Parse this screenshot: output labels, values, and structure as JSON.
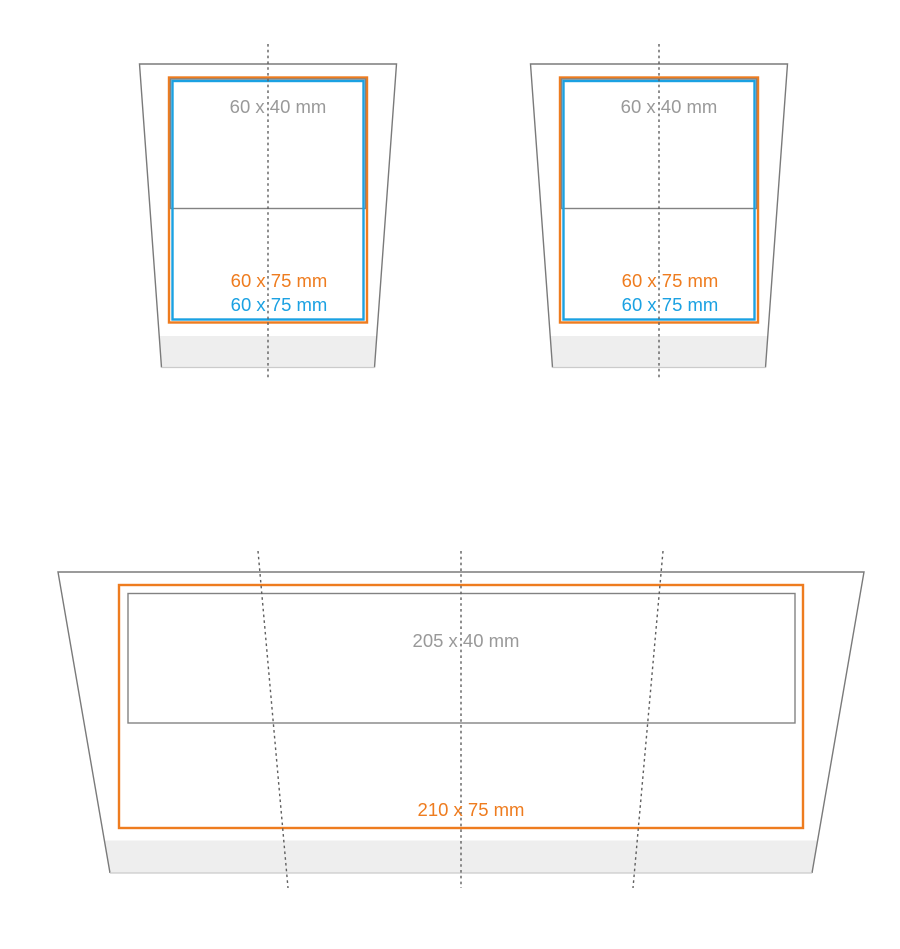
{
  "figures": {
    "cup_left": {
      "print_label": "60 x 40 mm",
      "max_label": "60 x 75 mm",
      "imprint_label": "60 x 75 mm"
    },
    "cup_right": {
      "print_label": "60 x 40 mm",
      "max_label": "60 x 75 mm",
      "imprint_label": "60 x 75 mm"
    },
    "wrap": {
      "print_label": "205 x 40 mm",
      "max_label": "210 x 75 mm"
    }
  },
  "colors": {
    "max_area_orange": "#ee7c1f",
    "imprint_blue": "#1ba1e2",
    "outline_gray": "#7a7a7a",
    "inner_gray": "#828282",
    "label_gray": "#999999",
    "base_fill": "#eeeeee",
    "bottom_edge_gray": "#cbcbcb",
    "seam_gray": "#5f5f5f"
  }
}
